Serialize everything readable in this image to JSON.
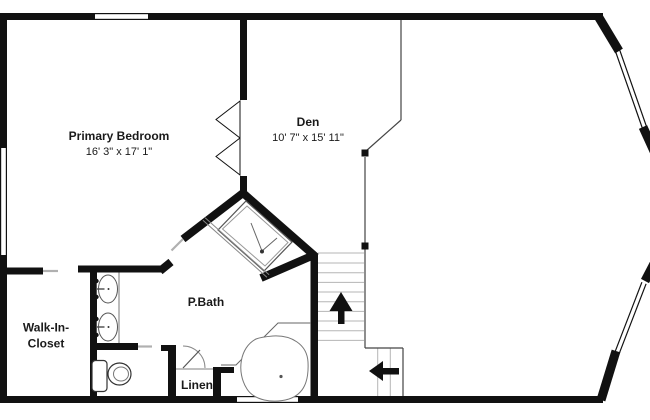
{
  "meta": {
    "type": "floor-plan"
  },
  "rooms": {
    "primary_bedroom": {
      "label": "Primary Bedroom",
      "dimensions": "16' 3\" x 17' 1\""
    },
    "den": {
      "label": "Den",
      "dimensions": "10' 7\" x 15' 11\""
    },
    "pbath": {
      "label": "P.Bath"
    },
    "walk_in_closet": {
      "label_line1": "Walk-In-",
      "label_line2": "Closet"
    },
    "linen": {
      "label": "Linen"
    }
  },
  "fixtures": {
    "shower": "corner-shower",
    "tub": "corner-soaking-tub",
    "toilet": "toilet",
    "vanity": "double-sink-vanity",
    "stairs_up_arrow": "up-arrow",
    "stairs_lower_arrow": "left-arrow",
    "double_door": "double-swing-door",
    "windows": "double-line-windows"
  },
  "colors": {
    "wall": "#111111",
    "background": "#ffffff",
    "thin_line": "#444444",
    "tread_line": "#b5b5b5",
    "fixture_line": "#666666",
    "door_gap": "#b0b0b0"
  }
}
